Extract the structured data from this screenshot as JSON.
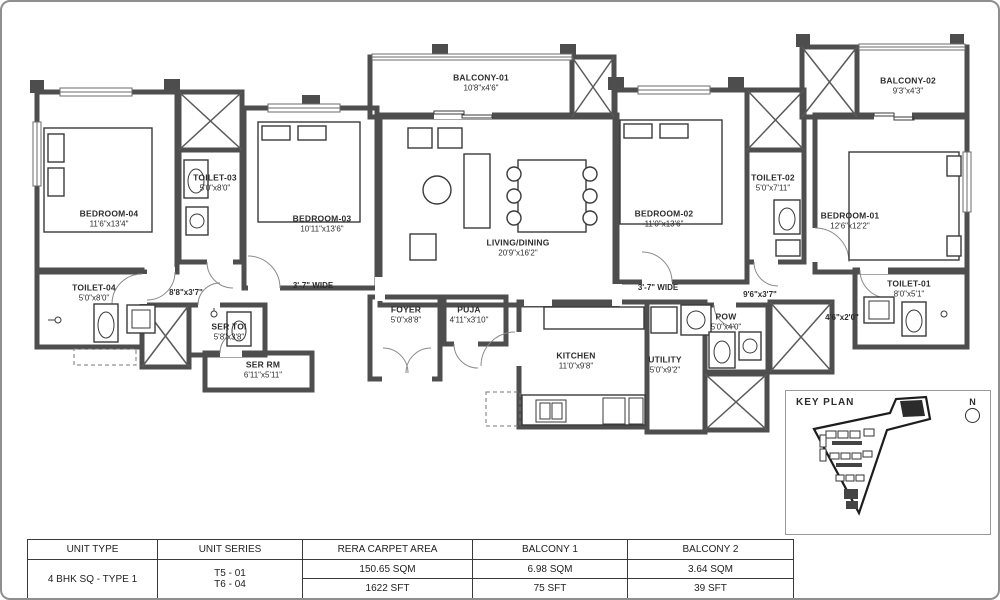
{
  "rooms": {
    "bedroom04": {
      "name": "BEDROOM-04",
      "dim": "11'6\"x13'4\""
    },
    "bedroom03": {
      "name": "BEDROOM-03",
      "dim": "10'11\"x13'6\""
    },
    "bedroom02": {
      "name": "BEDROOM-02",
      "dim": "11'0\"x13'6\""
    },
    "bedroom01": {
      "name": "BEDROOM-01",
      "dim": "12'6\"x12'2\""
    },
    "toilet01": {
      "name": "TOILET-01",
      "dim": "8'0\"x5'1\""
    },
    "toilet02": {
      "name": "TOILET-02",
      "dim": "5'0\"x7'11\""
    },
    "toilet03": {
      "name": "TOILET-03",
      "dim": "5'0\"x8'0\""
    },
    "toilet04": {
      "name": "TOILET-04",
      "dim": "5'0\"x8'0\""
    },
    "balcony01": {
      "name": "BALCONY-01",
      "dim": "10'8\"x4'6\""
    },
    "balcony02": {
      "name": "BALCONY-02",
      "dim": "9'3\"x4'3\""
    },
    "living": {
      "name": "LIVING/DINING",
      "dim": "20'9\"x16'2\""
    },
    "foyer": {
      "name": "FOYER",
      "dim": "5'0\"x8'8\""
    },
    "puja": {
      "name": "PUJA",
      "dim": "4'11\"x3'10\""
    },
    "kitchen": {
      "name": "KITCHEN",
      "dim": "11'0\"x9'8\""
    },
    "utility": {
      "name": "UTILITY",
      "dim": "5'0\"x9'2\""
    },
    "pow": {
      "name": "POW",
      "dim": "5'0\"x4'0\""
    },
    "sertoi": {
      "name": "SER TOI",
      "dim": "5'8\"x3'8\""
    },
    "serrm": {
      "name": "SER RM",
      "dim": "6'11\"x5'11\""
    }
  },
  "passages": {
    "left_corridor": "8'8\"x3'7\"",
    "left_wide": "3'-7\" WIDE",
    "right_wide": "3'-7\" WIDE",
    "right_corridor": "9'6\"x3'7\"",
    "toilet1_passage": "4'6\"x2'0\""
  },
  "key_plan": {
    "title": "KEY PLAN",
    "north": "N"
  },
  "table": {
    "headers": [
      "UNIT TYPE",
      "UNIT SERIES",
      "RERA CARPET AREA",
      "BALCONY 1",
      "BALCONY 2"
    ],
    "unit_type": "4 BHK SQ - TYPE 1",
    "unit_series_line1": "T5 - 01",
    "unit_series_line2": "T6 - 04",
    "rera_sqm": "150.65 SQM",
    "rera_sft": "1622 SFT",
    "balcony1_sqm": "6.98 SQM",
    "balcony1_sft": "75 SFT",
    "balcony2_sqm": "3.64 SQM",
    "balcony2_sft": "39 SFT"
  },
  "colors": {
    "wall": "#4e4e4e",
    "text": "#2d2d2d",
    "border": "#8f8f8f"
  }
}
